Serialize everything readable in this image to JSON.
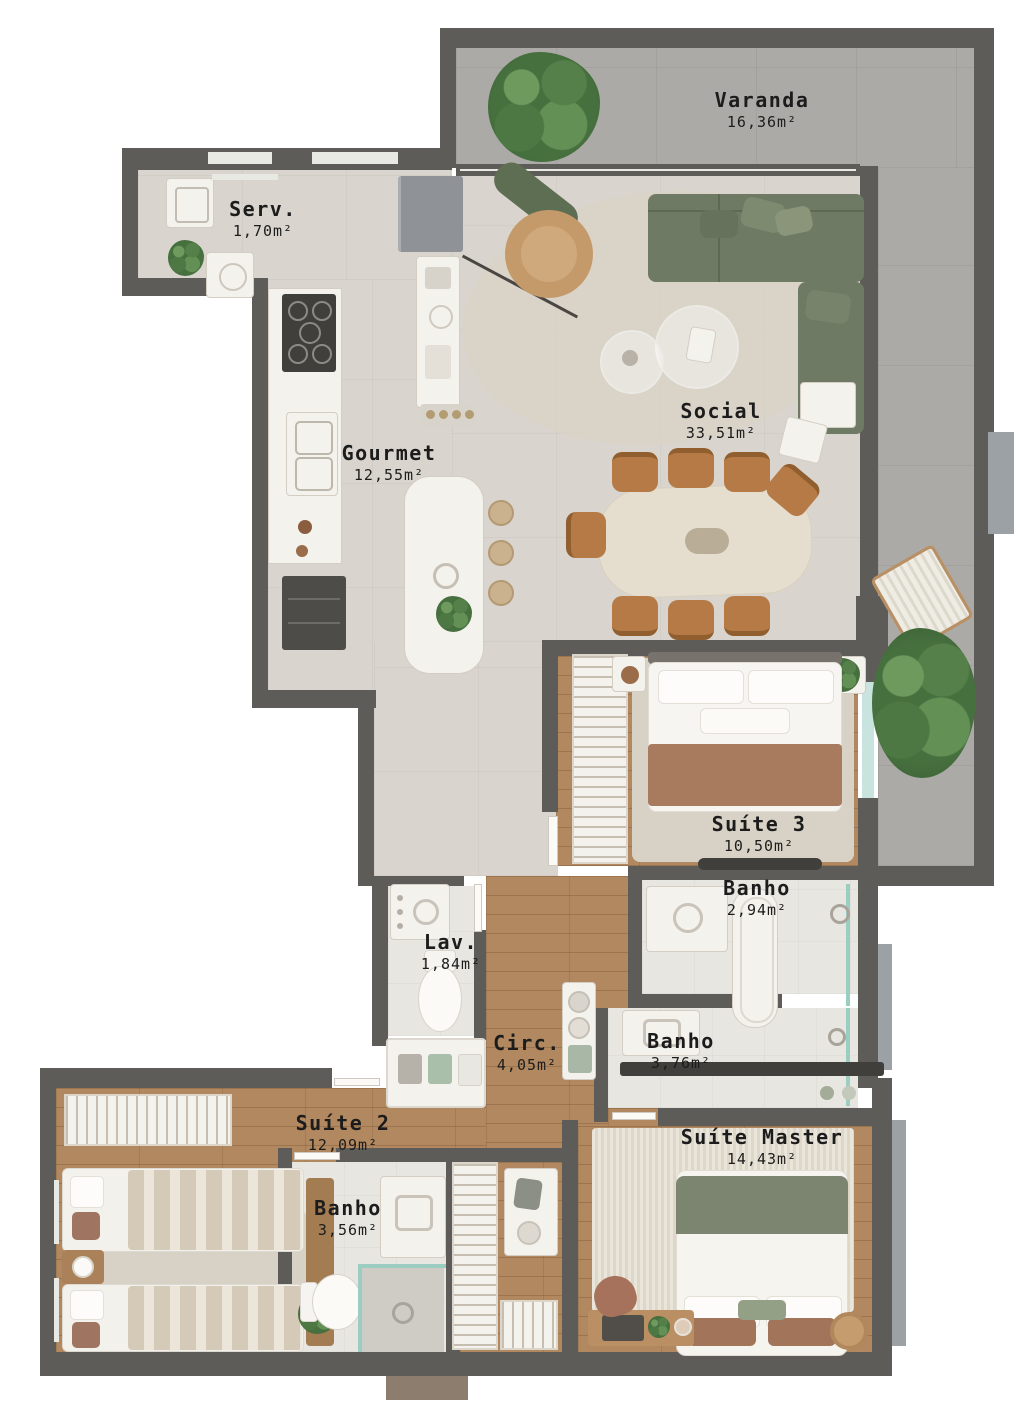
{
  "plan_type": "apartment-floor-plan",
  "rooms": [
    {
      "id": "varanda",
      "name": "Varanda",
      "area": "16,36m²"
    },
    {
      "id": "servico",
      "name": "Serv.",
      "area": "1,70m²"
    },
    {
      "id": "social",
      "name": "Social",
      "area": "33,51m²"
    },
    {
      "id": "gourmet",
      "name": "Gourmet",
      "area": "12,55m²"
    },
    {
      "id": "suite-3",
      "name": "Suíte 3",
      "area": "10,50m²"
    },
    {
      "id": "banho-suite-3",
      "name": "Banho",
      "area": "2,94m²"
    },
    {
      "id": "lavabo",
      "name": "Lav.",
      "area": "1,84m²"
    },
    {
      "id": "circulacao",
      "name": "Circ.",
      "area": "4,05m²"
    },
    {
      "id": "banho-376",
      "name": "Banho",
      "area": "3,76m²"
    },
    {
      "id": "suite-2",
      "name": "Suíte 2",
      "area": "12,09m²"
    },
    {
      "id": "banho-suite-2",
      "name": "Banho",
      "area": "3,56m²"
    },
    {
      "id": "suite-master",
      "name": "Suíte Master",
      "area": "14,43m²"
    }
  ],
  "colors": {
    "background": "#ffffff",
    "wall": "#5e5c58",
    "wall_texture": "#9ba1a4",
    "varanda_floor": "#acaaa6",
    "tile_floor": "#d9d5ce",
    "bath_floor": "#e8e6e1",
    "wood_floor": "#b1885f",
    "rug": "#d8d2c6",
    "sofa_green": "#6e7a63",
    "chair_leather": "#b57a45",
    "armchair_tan": "#c59a6b",
    "bed_blanket_brown": "#a87a5e",
    "master_blanket_green": "#7c8570",
    "glass": "#9ccdc3",
    "white_furniture": "#f4f2ed",
    "dark_accent": "#413f3b",
    "table_stone": "#e5decf",
    "label_text": "#1c1c1c"
  }
}
